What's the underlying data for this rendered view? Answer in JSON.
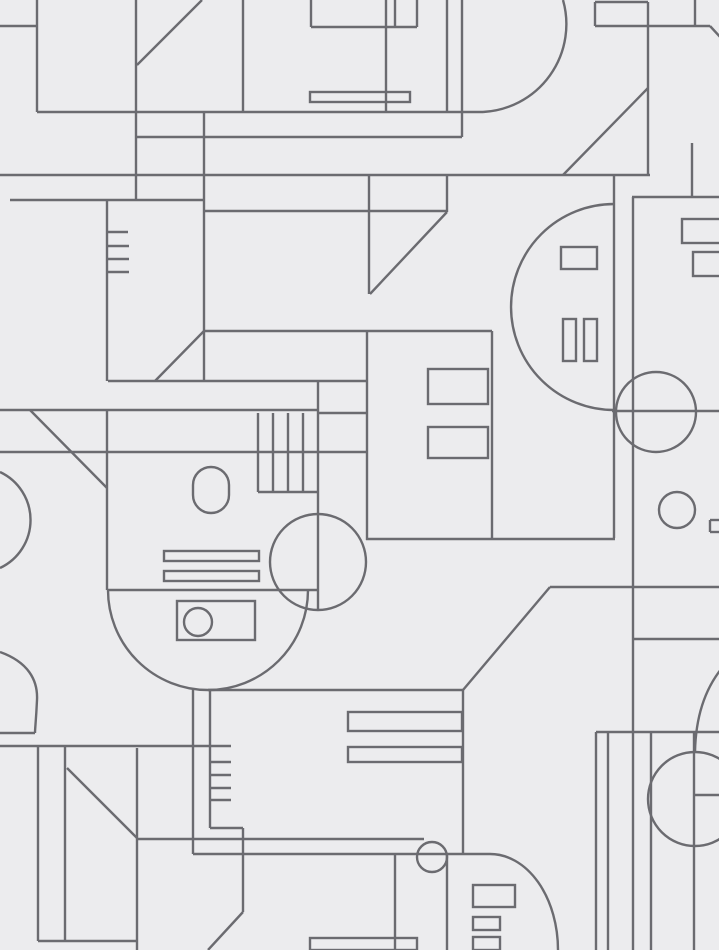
{
  "title": "Abstract geometric line-art wallpaper pattern",
  "canvas": {
    "width": 722,
    "height": 950,
    "background_color": "#ececee",
    "line_color": "#6b6b70",
    "line_width": 2.4,
    "edge_strip_color": "#ffffff",
    "edge_strip_width": 3
  },
  "pattern": {
    "lines": [
      [
        0,
        26,
        37,
        26
      ],
      [
        37,
        0,
        37,
        112
      ],
      [
        37,
        112,
        483,
        112
      ],
      [
        136,
        0,
        136,
        200
      ],
      [
        202,
        0,
        137,
        65
      ],
      [
        136,
        137,
        462,
        137
      ],
      [
        0,
        175,
        650,
        175
      ],
      [
        10,
        200,
        204,
        200
      ],
      [
        107,
        200,
        107,
        381
      ],
      [
        107,
        232,
        128,
        232
      ],
      [
        107,
        246,
        129,
        246
      ],
      [
        107,
        259,
        129,
        259
      ],
      [
        107,
        272,
        129,
        272
      ],
      [
        204,
        112,
        204,
        381
      ],
      [
        204,
        211,
        447,
        211
      ],
      [
        204,
        331,
        492,
        331
      ],
      [
        204,
        331,
        155,
        381
      ],
      [
        108,
        381,
        367,
        381
      ],
      [
        0,
        410,
        318,
        410
      ],
      [
        318,
        413,
        367,
        413
      ],
      [
        30,
        410,
        107,
        488
      ],
      [
        107,
        410,
        107,
        590
      ],
      [
        258,
        413,
        258,
        492
      ],
      [
        273,
        413,
        273,
        492
      ],
      [
        288,
        413,
        288,
        492
      ],
      [
        303,
        413,
        303,
        492
      ],
      [
        258,
        492,
        318,
        492
      ],
      [
        318,
        381,
        318,
        610
      ],
      [
        0,
        452,
        367,
        452
      ],
      [
        243,
        0,
        243,
        112
      ],
      [
        311,
        0,
        311,
        27
      ],
      [
        311,
        27,
        417,
        27
      ],
      [
        395,
        0,
        395,
        27
      ],
      [
        417,
        0,
        417,
        27
      ],
      [
        386,
        0,
        386,
        112
      ],
      [
        447,
        0,
        447,
        112
      ],
      [
        462,
        0,
        462,
        137
      ],
      [
        447,
        175,
        447,
        212
      ],
      [
        447,
        212,
        370,
        294
      ],
      [
        369,
        175,
        369,
        294
      ],
      [
        367,
        331,
        367,
        540
      ],
      [
        595,
        2,
        648,
        2
      ],
      [
        595,
        2,
        595,
        26
      ],
      [
        648,
        2,
        648,
        175
      ],
      [
        595,
        26,
        710,
        26
      ],
      [
        695,
        0,
        695,
        26
      ],
      [
        710,
        26,
        722,
        39
      ],
      [
        648,
        88,
        563,
        175
      ],
      [
        614,
        175,
        614,
        538
      ],
      [
        633,
        197,
        633,
        950
      ],
      [
        632,
        197,
        722,
        197
      ],
      [
        692,
        143,
        692,
        197
      ],
      [
        612,
        411,
        722,
        411
      ],
      [
        492,
        331,
        492,
        538
      ],
      [
        366,
        539,
        615,
        539
      ],
      [
        550,
        587,
        722,
        587
      ],
      [
        463,
        690,
        550,
        587
      ],
      [
        208,
        690,
        463,
        690
      ],
      [
        633,
        639,
        722,
        639
      ],
      [
        107,
        590,
        318,
        590
      ],
      [
        193,
        689,
        193,
        854
      ],
      [
        210,
        690,
        210,
        828
      ],
      [
        210,
        762,
        231,
        762
      ],
      [
        210,
        775,
        231,
        775
      ],
      [
        210,
        788,
        231,
        788
      ],
      [
        210,
        800,
        231,
        800
      ],
      [
        0,
        733,
        35,
        733
      ],
      [
        0,
        746,
        231,
        746
      ],
      [
        38,
        746,
        38,
        941
      ],
      [
        65,
        746,
        65,
        941
      ],
      [
        38,
        941,
        137,
        941
      ],
      [
        137,
        748,
        137,
        950
      ],
      [
        67,
        768,
        137,
        838
      ],
      [
        137,
        839,
        424,
        839
      ],
      [
        210,
        828,
        243,
        828
      ],
      [
        243,
        828,
        243,
        912
      ],
      [
        243,
        912,
        208,
        950
      ],
      [
        193,
        854,
        490,
        854
      ],
      [
        395,
        854,
        395,
        950
      ],
      [
        447,
        854,
        447,
        950
      ],
      [
        463,
        690,
        463,
        854
      ],
      [
        596,
        732,
        722,
        732
      ],
      [
        596,
        732,
        596,
        950
      ],
      [
        608,
        732,
        608,
        950
      ],
      [
        651,
        732,
        651,
        950
      ],
      [
        694,
        732,
        694,
        950
      ],
      [
        695,
        795,
        722,
        795
      ],
      [
        722,
        520,
        710,
        520
      ],
      [
        710,
        520,
        710,
        532
      ],
      [
        710,
        532,
        722,
        532
      ]
    ],
    "rects": [
      [
        310,
        92,
        100,
        10,
        0
      ],
      [
        682,
        219,
        40,
        24,
        0
      ],
      [
        693,
        252,
        29,
        24,
        0
      ],
      [
        561,
        247,
        36,
        22,
        0
      ],
      [
        563,
        319,
        13,
        42,
        0
      ],
      [
        584,
        319,
        13,
        42,
        0
      ],
      [
        428,
        369,
        60,
        35,
        0
      ],
      [
        428,
        427,
        60,
        31,
        0
      ],
      [
        193,
        467,
        36,
        46,
        18
      ],
      [
        164,
        551,
        95,
        10,
        0
      ],
      [
        164,
        571,
        95,
        10,
        0
      ],
      [
        177,
        601,
        78,
        39,
        0
      ],
      [
        348,
        712,
        114,
        19,
        0
      ],
      [
        348,
        747,
        114,
        15,
        0
      ],
      [
        310,
        938,
        107,
        12,
        0
      ],
      [
        473,
        885,
        42,
        22,
        0
      ],
      [
        473,
        917,
        27,
        13,
        0
      ],
      [
        473,
        937,
        27,
        13,
        0
      ]
    ],
    "circles": [
      [
        656,
        412,
        40
      ],
      [
        677,
        510,
        18
      ],
      [
        318,
        562,
        48
      ],
      [
        198,
        622,
        14
      ],
      [
        432,
        857,
        15
      ],
      [
        695,
        799,
        47
      ]
    ],
    "arcs": [
      "M 563 0 A 88 88 0 0 1 483 112",
      "M 614 204 A 103 103 0 0 0 614 410",
      "M 108 590 A 100 100 0 0 0 308 590",
      "M 0 472 A 53 53 0 0 1 0 568",
      "M 0 652 C 28 662 38 680 37 700 C 36 722 35 728 35 733",
      "M 490 854 A 68 96 0 0 1 558 950",
      "M 722 668 Q 696 700 695 752"
    ]
  }
}
